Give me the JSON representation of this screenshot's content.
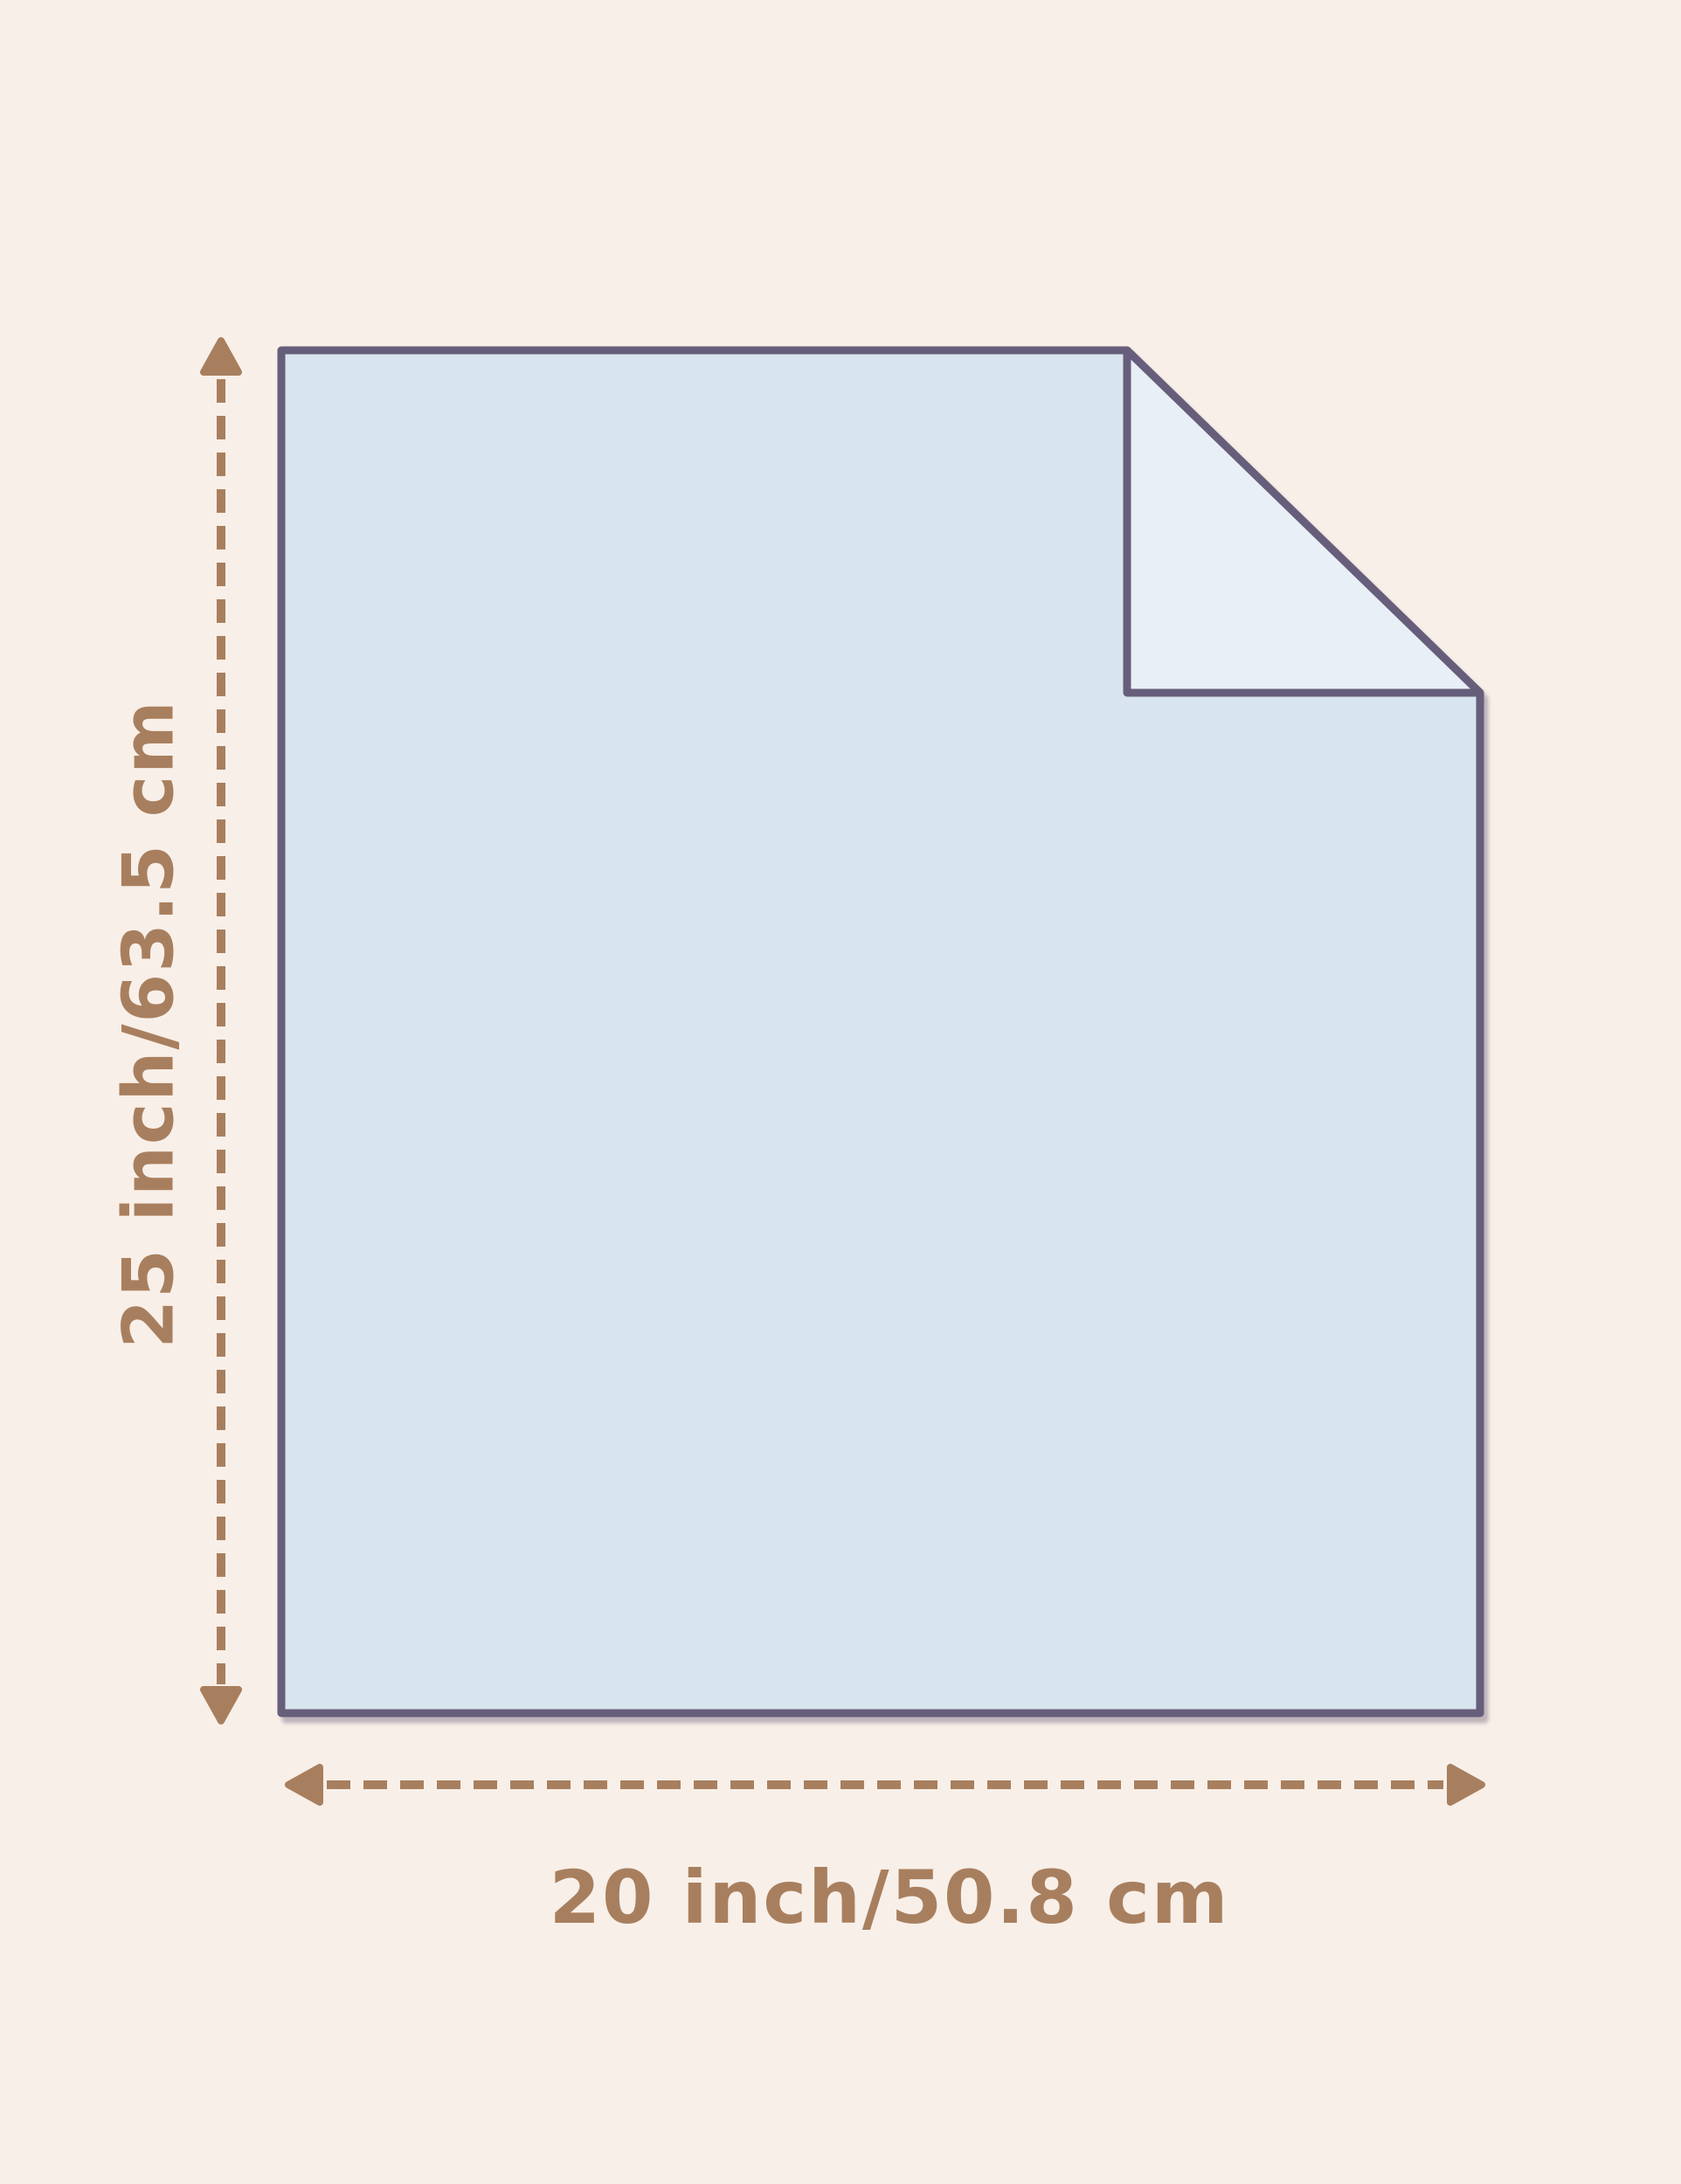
{
  "labels": {
    "height": "25 inch/63.5 cm",
    "width": "20 inch/50.8 cm"
  },
  "colors": {
    "background": "#f8efe8",
    "sheet-fill": "#d8e5ee",
    "fold-fill": "#e9eff6",
    "outline": "#665e7a",
    "accent": "#a87f5e"
  }
}
